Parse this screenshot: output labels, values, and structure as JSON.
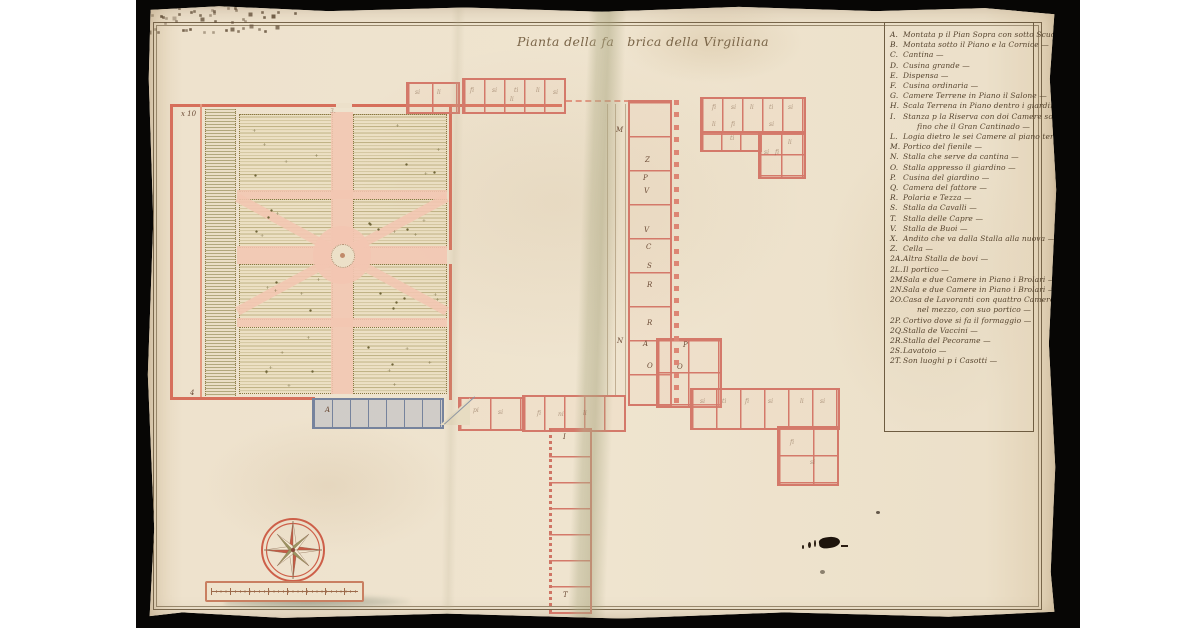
{
  "title": {
    "full": "Pianta della fabrica della Virgiliana",
    "part1": "Pianta della fa",
    "part2": "brica della Virgiliana"
  },
  "legend": {
    "entries": [
      {
        "letter": "A",
        "text": "Montata p il Pian Sopra con sotto Scuderia —"
      },
      {
        "letter": "B",
        "text": "Montata sotto il Piano e la Cornice — que seguono contigue —"
      },
      {
        "letter": "C",
        "text": "Cantina —"
      },
      {
        "letter": "D",
        "text": "Cusina grande —"
      },
      {
        "letter": "E",
        "text": "Dispensa —"
      },
      {
        "letter": "F",
        "text": "Cusina ordinaria —"
      },
      {
        "letter": "G",
        "text": "Camere Terrene in Piano il Salone —"
      },
      {
        "letter": "H",
        "text": "Scala Terrena in Piano dentro i giardini —"
      },
      {
        "letter": "I",
        "text": "Stanza p la Riserva con doi Camere sotto, e Logia sotta,"
      },
      {
        "letter": "",
        "text": "fino che il Gran Cantinado —",
        "cont": true
      },
      {
        "letter": "L",
        "text": "Logia dietro le sei Camere al piano terreno —"
      },
      {
        "letter": "M",
        "text": "Portico del fienile —"
      },
      {
        "letter": "N",
        "text": "Stalla che serve da cantina —"
      },
      {
        "letter": "O",
        "text": "Stalla appresso il giardino —"
      },
      {
        "letter": "P",
        "text": "Cusina del giardino —"
      },
      {
        "letter": "Q",
        "text": "Camera del fattore —"
      },
      {
        "letter": "R",
        "text": "Polaria e Tezza —"
      },
      {
        "letter": "S",
        "text": "Stalla da Cavalli —"
      },
      {
        "letter": "T",
        "text": "Stalla delle Capre —"
      },
      {
        "letter": "V",
        "text": "Stalla de Buoi —"
      },
      {
        "letter": "X",
        "text": "Andito che va dalla Stalla alla nuova —"
      },
      {
        "letter": "Z",
        "text": "Cella —"
      },
      {
        "letter": "2A",
        "text": "Altra Stalla de bovi —"
      },
      {
        "letter": "2L",
        "text": "Il portico —"
      },
      {
        "letter": "2M",
        "text": "Sala e due Camere in Piano i Brolari —"
      },
      {
        "letter": "2N",
        "text": "Sala e due Camere in Piano i Brolari —"
      },
      {
        "letter": "2O",
        "text": "Casa de Lavoranti con quattro Camere e Sala Antica"
      },
      {
        "letter": "",
        "text": "nel mezzo, con suo portico —",
        "cont": true
      },
      {
        "letter": "2P",
        "text": "Cortivo dove si fa il formaggio —"
      },
      {
        "letter": "2Q",
        "text": "Stalla de Vaccini —"
      },
      {
        "letter": "2R",
        "text": "Stalla del Pecorame —"
      },
      {
        "letter": "2S",
        "text": "Lavatoio —"
      },
      {
        "letter": "2T",
        "text": "Son luoghi p i Casotti —"
      }
    ]
  },
  "plan": {
    "room_labels": [
      {
        "x": 470,
        "y": 122,
        "t": "M"
      },
      {
        "x": 499,
        "y": 152,
        "t": "Z"
      },
      {
        "x": 497,
        "y": 170,
        "t": "P"
      },
      {
        "x": 498,
        "y": 183,
        "t": "V"
      },
      {
        "x": 498,
        "y": 222,
        "t": "V"
      },
      {
        "x": 500,
        "y": 239,
        "t": "C"
      },
      {
        "x": 501,
        "y": 258,
        "t": "S"
      },
      {
        "x": 501,
        "y": 277,
        "t": "R"
      },
      {
        "x": 501,
        "y": 315,
        "t": "R"
      },
      {
        "x": 471,
        "y": 333,
        "t": "N"
      },
      {
        "x": 497,
        "y": 336,
        "t": "A"
      },
      {
        "x": 501,
        "y": 358,
        "t": "O"
      },
      {
        "x": 531,
        "y": 359,
        "t": "O"
      },
      {
        "x": 537,
        "y": 337,
        "t": "P"
      },
      {
        "x": 417,
        "y": 429,
        "t": "I"
      },
      {
        "x": 417,
        "y": 587,
        "t": "T"
      },
      {
        "x": 179,
        "y": 402,
        "t": "A"
      },
      {
        "x": 44,
        "y": 385,
        "t": "4"
      },
      {
        "x": 35,
        "y": 106,
        "t": "x 10"
      }
    ],
    "scribbles": [
      {
        "x": 269,
        "y": 85,
        "t": "si"
      },
      {
        "x": 291,
        "y": 85,
        "t": "li"
      },
      {
        "x": 324,
        "y": 83,
        "t": "fi"
      },
      {
        "x": 346,
        "y": 83,
        "t": "si"
      },
      {
        "x": 368,
        "y": 83,
        "t": "ti"
      },
      {
        "x": 390,
        "y": 83,
        "t": "li"
      },
      {
        "x": 407,
        "y": 85,
        "t": "si"
      },
      {
        "x": 566,
        "y": 100,
        "t": "fi"
      },
      {
        "x": 585,
        "y": 100,
        "t": "si"
      },
      {
        "x": 604,
        "y": 100,
        "t": "li"
      },
      {
        "x": 623,
        "y": 100,
        "t": "ti"
      },
      {
        "x": 642,
        "y": 100,
        "t": "si"
      },
      {
        "x": 566,
        "y": 117,
        "t": "li"
      },
      {
        "x": 585,
        "y": 117,
        "t": "fi"
      },
      {
        "x": 623,
        "y": 117,
        "t": "si"
      },
      {
        "x": 642,
        "y": 135,
        "t": "li"
      },
      {
        "x": 618,
        "y": 145,
        "t": "si"
      },
      {
        "x": 584,
        "y": 131,
        "t": "ti"
      },
      {
        "x": 629,
        "y": 145,
        "t": "fi"
      },
      {
        "x": 327,
        "y": 403,
        "t": "pi"
      },
      {
        "x": 352,
        "y": 405,
        "t": "si"
      },
      {
        "x": 391,
        "y": 406,
        "t": "fi"
      },
      {
        "x": 412,
        "y": 407,
        "t": "ni"
      },
      {
        "x": 437,
        "y": 406,
        "t": "li"
      },
      {
        "x": 554,
        "y": 394,
        "t": "si"
      },
      {
        "x": 576,
        "y": 394,
        "t": "ti"
      },
      {
        "x": 599,
        "y": 394,
        "t": "fi"
      },
      {
        "x": 622,
        "y": 394,
        "t": "si"
      },
      {
        "x": 654,
        "y": 394,
        "t": "li"
      },
      {
        "x": 674,
        "y": 394,
        "t": "si"
      },
      {
        "x": 644,
        "y": 435,
        "t": "fi"
      },
      {
        "x": 664,
        "y": 455,
        "t": "si"
      },
      {
        "x": 184,
        "y": 104,
        "t": "3."
      },
      {
        "x": 364,
        "y": 92,
        "t": "li"
      }
    ],
    "colonnade": {
      "x": 528,
      "y_start": 95,
      "y_end": 393,
      "step": 12.4
    }
  }
}
